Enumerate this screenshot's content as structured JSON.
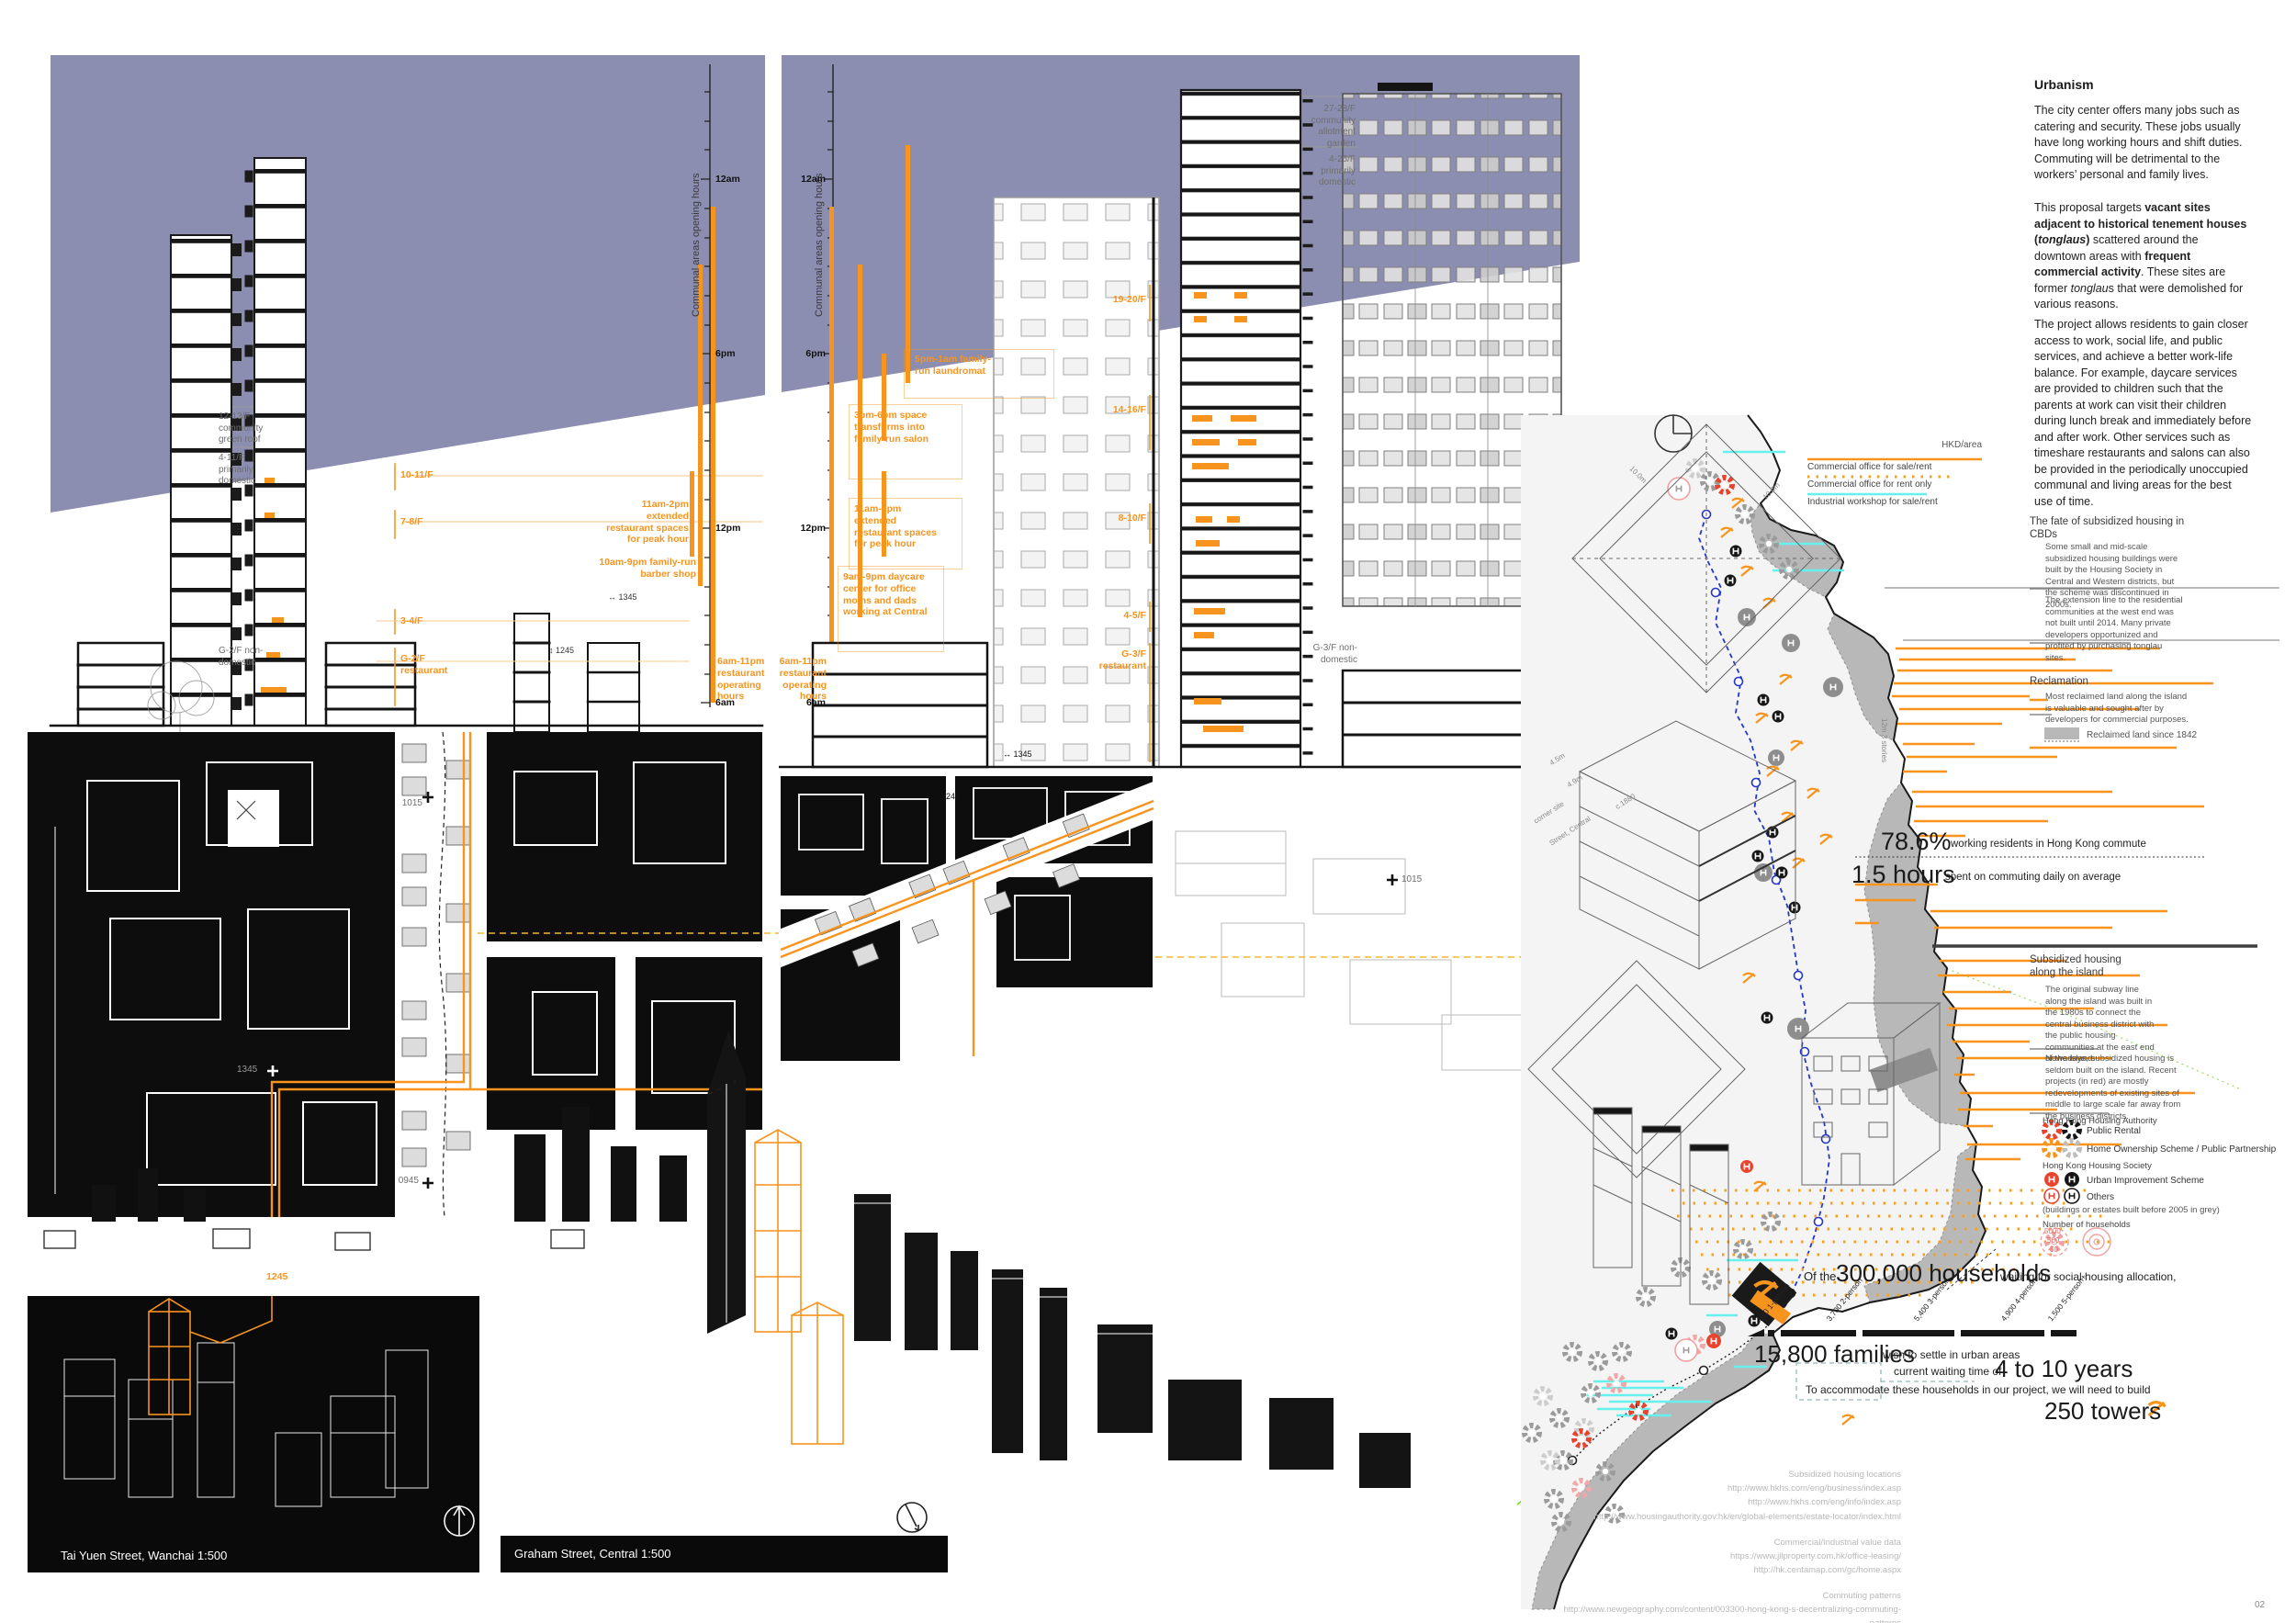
{
  "page": {
    "number": "02"
  },
  "panels": {
    "wanchai": {
      "title": "Tai Yuen Street, Wanchai 1:500",
      "timeline": {
        "title": "Communal areas opening hours",
        "ticks": [
          "12am",
          "6pm",
          "12pm",
          "6am"
        ],
        "ann1": "11am-2pm extended restaurant spaces for peak hour",
        "ann2": "10am-9pm family-run barber shop",
        "ann3": "6am-11pm restaurant operating hours"
      },
      "floors_grey": [
        "12-13/F community green roof",
        "4-11/F primarily domestic",
        "G-2/F non- domestic"
      ],
      "floors_orange": [
        "10-11/F",
        "7-8/F",
        "3-4/F",
        "G-2/F restaurant"
      ],
      "times": [
        "1015",
        "1345",
        "0945",
        "1245"
      ],
      "dims": [
        "↔ 1345",
        "↕ 1245"
      ]
    },
    "central": {
      "title": "Graham Street, Central 1:500",
      "timeline": {
        "title": "Communal areas opening hours",
        "ticks": [
          "12am",
          "6pm",
          "12pm",
          "6am"
        ],
        "ann1": "5pm-1am family-run laundromat",
        "ann2": "3pm-6pm space transforms into family-run salon",
        "ann3": "11am-2pm extended restaurant spaces for peak hour",
        "ann4": "9am-9pm daycare center for office moms and dads working at Central",
        "ann5": "6am-11pm restaurant operating hours"
      },
      "floors_grey": [
        "27-28/F community allotment garden",
        "4-26/F primarily domestic",
        "G-3/F non- domestic"
      ],
      "floors_orange": [
        "19-20/F",
        "14-16/F",
        "8-10/F",
        "4-5/F",
        "G-3/F restaurant"
      ],
      "times": [
        "↔ 1345",
        "↕ 1245",
        "1015"
      ]
    }
  },
  "map": {
    "legend": {
      "unit": "HKD/area",
      "items": [
        "Commercial office for sale/rent",
        "Commercial office for rent only",
        "Industrial workshop for sale/rent"
      ]
    },
    "dims": [
      "10.0m",
      "10.0m",
      "12m  3 stories",
      "4.5m",
      "4.9m",
      "corner site",
      "Street, Central",
      "c.1880"
    ],
    "colors": {
      "orange": "#f7941e",
      "cyan": "#66f0ee",
      "purple": "#8c8eb1",
      "reclaimed": "#b8b8b8",
      "mtr_blue": "#2336c9",
      "green": "#74d421",
      "red": "#e8432e"
    }
  },
  "column": {
    "heading": "Urbanism",
    "p1": "The city center offers many jobs such as catering and security. These jobs usually have long working hours and shift duties. Commuting will be detrimental to the workers’ personal and family lives.",
    "proposal": {
      "s1": "This proposal targets ",
      "s2": "vacant sites adjacent to historical tenement houses (",
      "s3": "tonglaus",
      "s4": ") ",
      "s5": "scattered around the downtown areas with ",
      "s6": "frequent commercial activity",
      "s7": ". These sites are former ",
      "s8": "tonglau",
      "s9": "s that were demolished for various reasons."
    },
    "p3": "The project allows residents to gain closer access to work, social life, and public services, and achieve a better work-life balance. For example, daycare services are provided to children such that the parents at work can visit their children during lunch break and immediately before and after work. Other services such as timeshare restaurants and salons can also be provided in the periodically unoccupied communal and living areas for the best use of time.",
    "fate": {
      "heading": "The fate of subsidized housing in CBDs",
      "a": "Some small and mid-scale subsidized housing buildings were built by the Housing Society in Central and Western districts, but the scheme was discontinued in 2000s.",
      "b": "The extension line to the residential communities at the west end was not built until 2014. Many private developers opportunized and profited by purchasing tonglau sites."
    },
    "reclamation": {
      "heading": "Reclamation",
      "a": "Most reclaimed land along the island is valuable and sought after by developers for commercial purposes.",
      "legend": "Reclaimed land since 1842"
    },
    "commute": {
      "pct": "78.6%",
      "pct_label": "working residents in Hong Kong commute",
      "hours": "1.5 hours",
      "hours_label": "spent on commuting daily on average"
    },
    "subsidized": {
      "heading": "Subsidized housing along the island",
      "a": "The original subway line along the island was built in the 1980s to connect the central business district with the public housing communities at the east end of the island.",
      "b": "Nowadays, subsidized housing is seldom built on the island. Recent projects (in red) are mostly redevelopments of existing sites of middle to large scale far away from the business districts.",
      "authority": "Hong Kong Housing Authority",
      "auth1": "Public Rental",
      "auth2": "Home Ownership Scheme / Public Partnership",
      "society": "Hong Kong Housing Society",
      "soc1": "Urban Improvement Scheme",
      "soc2": "Others",
      "note": "(buildings or estates built before 2005 in grey)",
      "households_heading": "Number of households",
      "scale": [
        "5000",
        "500",
        "50"
      ]
    }
  },
  "households": {
    "intro_pre": "Of the",
    "intro_big": "300,000 households",
    "intro_post": "waiting for social housing allocation,",
    "bar_labels": [
      "300 1-person",
      "3,700 2-person",
      "5,400 3-person",
      "4,900 4-person",
      "1,500 5-person+"
    ],
    "families": "15,800 families",
    "families_label": "wish to settle in urban areas",
    "wait_pre": "current waiting time of",
    "wait_big": "4 to 10 years",
    "build_line": "To accommodate these households in our project, we will need to build",
    "towers": "250 towers"
  },
  "chart_data": {
    "type": "bar",
    "title": "Of the 300,000 households waiting for social housing allocation",
    "categories": [
      "1-person",
      "2-person",
      "3-person",
      "4-person",
      "5-person+"
    ],
    "values": [
      300,
      3700,
      5400,
      4900,
      1500
    ],
    "families_total": 15800,
    "waiting_total": 300000,
    "commute_share_pct": 78.6,
    "commute_hours_daily": 1.5,
    "current_waiting_years": "4 to 10",
    "towers_needed": 250,
    "legend_position": "labels rotated above bar",
    "xlabel": "household size",
    "ylabel": "households"
  },
  "sources": {
    "s1": "Subsidized housing locations\nhttp://www.hkhs.com/eng/business/index.asp\nhttp://www.hkhs.com/eng/info/index.asp\nhttp://www.housingauthority.gov.hk/en/global-elements/estate-locator/index.html",
    "s2": "Commercial/Industrial value data\nhttps://www.jllproperty.com.hk/office-leasing/\nhttp://hk.centamap.com/gc/home.aspx",
    "s3": "Commuting patterns\nhttp://www.newgeography.com/content/003300-hong-kong-s-decentralizing-commuting-patterns"
  }
}
